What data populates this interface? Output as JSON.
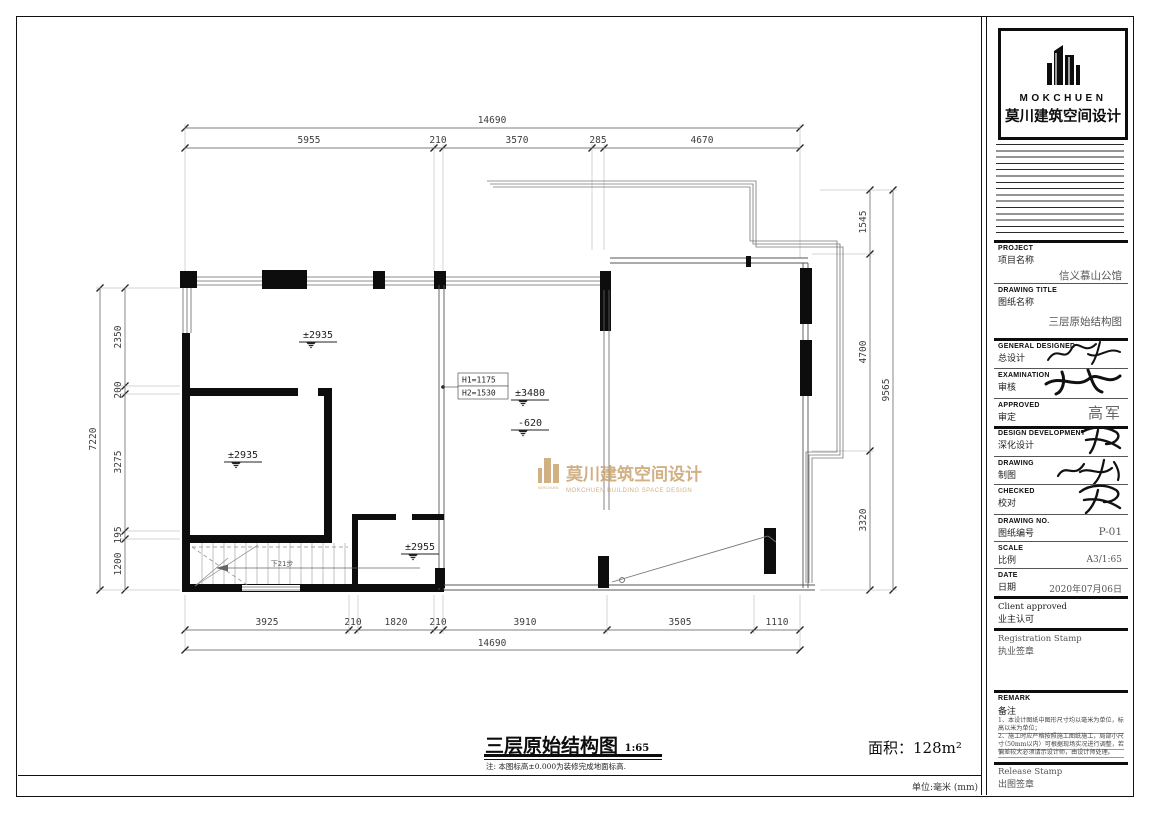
{
  "logo": {
    "name_en": "MOKCHUEN",
    "name_cn": "莫川建筑空间设计"
  },
  "titleblock": {
    "project_en": "PROJECT",
    "project_cn": "项目名称",
    "project_value": "信义慕山公馆",
    "drawing_title_en": "DRAWING TITLE",
    "drawing_title_cn": "图纸名称",
    "drawing_title_value": "三层原始结构图",
    "general_designed_en": "GENERAL  DESIGNED",
    "general_designed_cn": "总设计",
    "examination_en": "EXAMINATION",
    "examination_cn": "审核",
    "approved_en": "APPROVED",
    "approved_cn": "审定",
    "approved_value": "高军",
    "design_dev_en": "DESIGN DEVELOPMENT",
    "design_dev_cn": "深化设计",
    "drawing_en": "DRAWING",
    "drawing_cn": "制图",
    "checked_en": "CHECKED",
    "checked_cn": "校对",
    "drawing_no_en": "DRAWING NO.",
    "drawing_no_cn": "图纸编号",
    "drawing_no_value": "P-01",
    "scale_en": "SCALE",
    "scale_cn": "比例",
    "scale_value": "A3/1:65",
    "date_en": "DATE",
    "date_cn": "日期",
    "date_value": "2020年07月06日",
    "client_approved_en": "Client approved",
    "client_approved_cn": "业主认可",
    "registration_en": "Registration Stamp",
    "registration_cn": "执业签章",
    "remark_en": "REMARK",
    "remark_cn": "备注",
    "remark_lines": [
      "1、本设计图纸中图形尺寸均以毫米为单位，标高",
      "　以米为单位；",
      "2、施工时应严格按照施工图纸施工，局部小尺寸",
      "　（50mm以内）可根据现场实况进行调整，若偏",
      "　差较大必须请示设计师，由设计师处理。"
    ],
    "release_en": "Release Stamp",
    "release_cn": "出图签章"
  },
  "caption": {
    "title": "三层原始结构图",
    "scale": "1:65",
    "note": "注: 本图标高±0.000为装修完成地面标高.",
    "area_label": "面积：",
    "area_value": "128m²",
    "unit_note": "单位:毫米 (mm)"
  },
  "watermark": {
    "cn": "莫川建筑空间设计",
    "en": "MOKCHUEN BUILDING SPACE DESIGN",
    "small": "MOKCHUEN",
    "color": "#c9a36f"
  },
  "plan": {
    "levels": {
      "room_top": "±2935",
      "room_inner": "±2935",
      "hall": "±3480",
      "hall_low": "-620",
      "stair_room": "±2955"
    },
    "callout": {
      "line1": "H1=1175",
      "line2": "H2=1530"
    },
    "stair_note": "下21步",
    "dims": {
      "top_total": "14690",
      "top_segments": [
        "5955",
        "210",
        "3570",
        "285",
        "4670"
      ],
      "bottom_segments": [
        "3925",
        "210",
        "1820",
        "210",
        "3910",
        "3505",
        "1110"
      ],
      "bottom_total": "14690",
      "left_total": "7220",
      "left_segments": [
        "2350",
        "200",
        "3275",
        "195",
        "1200"
      ],
      "right_segments": [
        "1545",
        "4700",
        "3320"
      ],
      "right_total": "9565"
    }
  }
}
